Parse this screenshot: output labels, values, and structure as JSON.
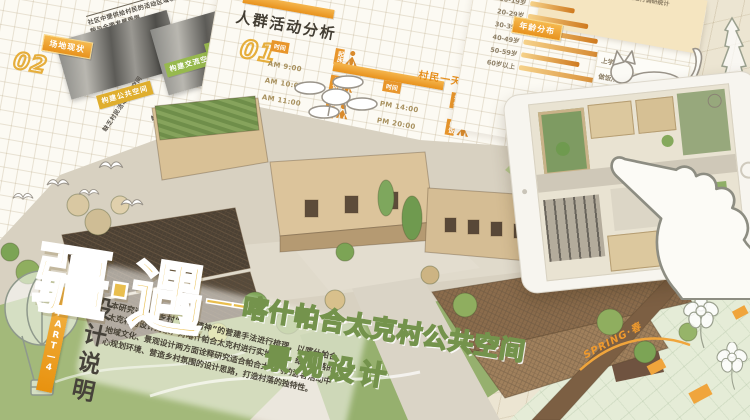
{
  "poster": {
    "part_label": "PART—4",
    "section_title": "设计说明",
    "description": "本研究通过对乡村“场所精神”的营建手法进行梳理，以喀什帕合太克村为设计对象，对喀什帕合太克村进行实地考察，结合村落的地域文化、景观设计两方面诠释研究适合帕合太克村的游客活动中心规划环境、营造乡村氛围的设计思路，打造村落的独特性。",
    "title": "疆·遇",
    "title_dash": "——",
    "subtitle_line1": "喀什帕合太克村公共空间",
    "subtitle_line2": "景观设计"
  },
  "site_status_panel": {
    "number": "02",
    "label": "场地现状",
    "caption": "社区中提供给村民的活动区域较少，静态活动空间，村民风貌与全面发展受限",
    "photo_captions": [
      "缺乏村民活动交流空间",
      "缺乏村民游客游憩空间"
    ],
    "tags": [
      {
        "label": "构建公共空间",
        "color": "#dfae2e"
      },
      {
        "label": "构建交流空间",
        "color": "#97b94e"
      },
      {
        "label": "构建游憩空间",
        "color": "#97b94e"
      }
    ]
  },
  "activity_panel": {
    "number": "01",
    "title": "人群活动分析",
    "timetable_label": "村民一天活动时间表",
    "time_header": "时间"
  },
  "age_panel": {
    "label": "年龄分布",
    "note": "对村民年龄结构与日常活动时间进行调研统计",
    "activities": [
      "上学/放学",
      "做饭/用餐",
      "农作",
      "赶集/巴扎",
      "休闲"
    ]
  },
  "chart_data": [
    {
      "type": "bar",
      "orientation": "horizontal",
      "title": "年龄分布",
      "categories": [
        "10-19岁",
        "20-29岁",
        "30-39岁",
        "40-49岁",
        "50-59岁",
        "60岁以上"
      ],
      "values": [
        38,
        52,
        62,
        78,
        50,
        88
      ],
      "xlabel": "",
      "ylabel": "",
      "value_note": "条形长度为估读相对值(0-100)，图中未标注数值",
      "legend": "none",
      "grid": true
    },
    {
      "type": "table",
      "title": "村民一天活动时间表",
      "columns": [
        "时间",
        "活动"
      ],
      "rows": [
        [
          "AM 9:00",
          "起床"
        ],
        [
          "AM 10:00",
          "做饭"
        ],
        [
          "AM 11:00",
          "农作"
        ],
        [
          "PM 13:00",
          "休闲"
        ],
        [
          "PM 14:00",
          "农作"
        ],
        [
          "PM 20:00",
          "晚饭"
        ],
        [
          "PM 21:00",
          "散步"
        ],
        [
          "PM 23:00",
          "睡觉"
        ]
      ]
    }
  ],
  "decor": {
    "spring_label": "SPRING·春",
    "icons": [
      "cat-icon",
      "pointing-hand-icon",
      "tablet-icon",
      "drone-icon",
      "bird-icon",
      "hot-air-balloon-icon",
      "poplar-tree-icon",
      "flower-icon"
    ],
    "colors": {
      "background": "#ece5d2",
      "board_edge_yellow": "#d7a63e",
      "accent_orange": "#e8931f",
      "title_yellow": "#e9be4e",
      "title_green": "#c9d8a2",
      "title_green_stroke": "#74934c"
    }
  }
}
